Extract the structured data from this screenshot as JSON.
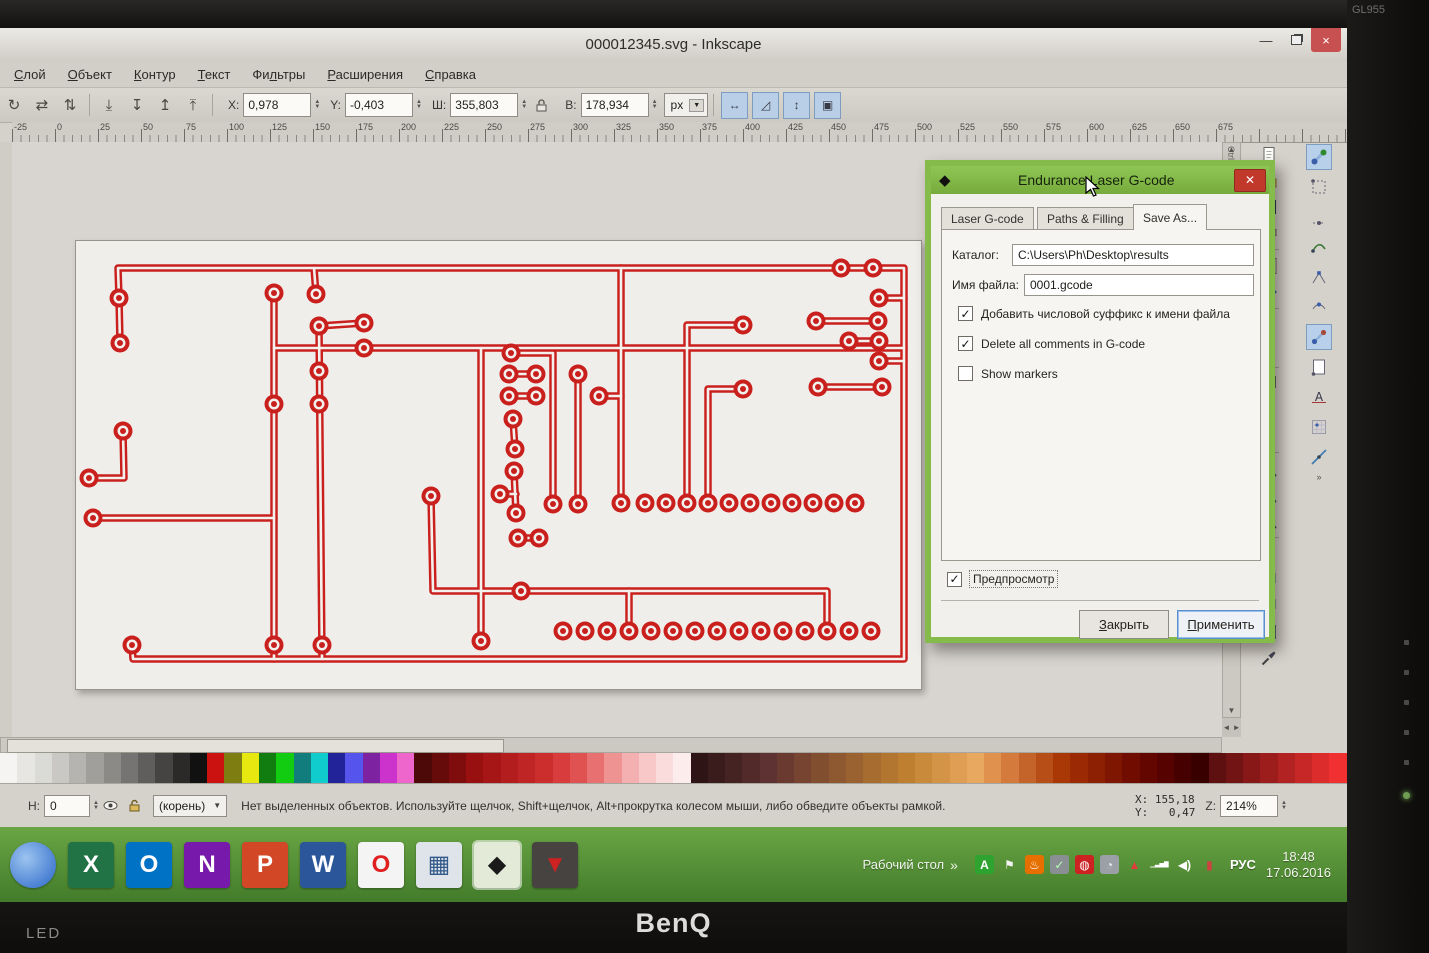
{
  "monitor": {
    "brand": "BenQ",
    "led_label": "LED",
    "model": "GL955",
    "bezel_buttons": [
      "auto-button",
      "menu-button",
      "up-button",
      "down-button",
      "enter-button"
    ]
  },
  "window": {
    "title": "000012345.svg - Inkscape"
  },
  "menu": {
    "items": [
      {
        "label": "Слой",
        "accel": 0
      },
      {
        "label": "Объект",
        "accel": 0
      },
      {
        "label": "Контур",
        "accel": 0
      },
      {
        "label": "Текст",
        "accel": 0
      },
      {
        "label": "Фильтры",
        "accel": 2
      },
      {
        "label": "Расширения",
        "accel": 0
      },
      {
        "label": "Справка",
        "accel": 0
      }
    ]
  },
  "toolbar": {
    "left_icons": [
      {
        "name": "rotate-90-icon",
        "glyph": "↻"
      },
      {
        "name": "flip-horizontal-icon",
        "glyph": "⇄"
      },
      {
        "name": "flip-vertical-icon",
        "glyph": "⇅"
      },
      {
        "name": "lower-to-bottom-icon",
        "glyph": "⤓"
      },
      {
        "name": "lower-icon",
        "glyph": "↧"
      },
      {
        "name": "raise-icon",
        "glyph": "↥"
      },
      {
        "name": "raise-to-top-icon",
        "glyph": "⤒"
      }
    ],
    "fields": [
      {
        "label": "X:",
        "value": "0,978",
        "name": "x-field"
      },
      {
        "label": "Y:",
        "value": "-0,403",
        "name": "y-field"
      },
      {
        "label": "Ш:",
        "value": "355,803",
        "name": "width-field"
      },
      {
        "label": "В:",
        "value": "178,934",
        "name": "height-field"
      }
    ],
    "units": "px",
    "toggle_icons": [
      {
        "name": "scale-stroke-toggle",
        "glyph": "↔"
      },
      {
        "name": "scale-corners-toggle",
        "glyph": "◿"
      },
      {
        "name": "scale-gradients-toggle",
        "glyph": "↕"
      },
      {
        "name": "scale-patterns-toggle",
        "glyph": "▣"
      }
    ]
  },
  "ruler": {
    "start": -25,
    "step": 25,
    "count": 29,
    "px_per_step": 43,
    "offset": 12
  },
  "scrollbars": {
    "ctrl_f_label": "Ctrl+F",
    "up": "▲",
    "down": "▼",
    "left": "◄",
    "right": "►",
    "more": "»"
  },
  "commands_bar": [
    "new-document-icon",
    "open-icon",
    "save-icon",
    "print-icon",
    "sep",
    "import-icon",
    "export-icon",
    "sep",
    "revert-icon",
    "cleanup-icon",
    "sep",
    "duplicate-icon",
    "scissors-icon",
    "clipboard-icon",
    "sep",
    "zoom-selection-icon",
    "zoom-drawing-icon",
    "zoom-page-icon",
    "sep",
    "text-icon",
    "raise-layer-icon",
    "lower-layer-icon",
    "grid-icon",
    "eyedropper-icon"
  ],
  "snap_bar": [
    {
      "name": "snap-master-icon",
      "active": true
    },
    {
      "name": "snap-bbox-icon",
      "active": false
    },
    {
      "name": "snap-bbox-edge-icon",
      "active": false
    },
    {
      "name": "snap-node-path-icon",
      "active": false
    },
    {
      "name": "snap-node-cusp-icon",
      "active": false
    },
    {
      "name": "snap-node-smooth-icon",
      "active": false
    },
    {
      "name": "snap-others-icon",
      "active": true
    },
    {
      "name": "snap-page-icon",
      "active": false
    },
    {
      "name": "snap-text-baseline-icon",
      "active": false
    },
    {
      "name": "snap-grid-icon",
      "active": false
    },
    {
      "name": "snap-guide-icon",
      "active": false
    }
  ],
  "dialog": {
    "title": "Endurance Laser G-code",
    "tabs": [
      "Laser G-code",
      "Paths & Filling",
      "Save As..."
    ],
    "active_tab": "Save As...",
    "fields": {
      "catalog_label": "Каталог:",
      "catalog_value": "C:\\Users\\Ph\\Desktop\\results",
      "filename_label": "Имя файла:",
      "filename_value": "0001.gcode"
    },
    "checkboxes": [
      {
        "label": "Добавить числовой суффикс к имени файла",
        "checked": true
      },
      {
        "label": "Delete all comments in G-code",
        "checked": true
      },
      {
        "label": "Show markers",
        "checked": false
      }
    ],
    "preview_checkbox": {
      "label": "Предпросмотр",
      "checked": true
    },
    "buttons": [
      {
        "label": "Закрыть",
        "accel": 0,
        "name": "dialog-close-button"
      },
      {
        "label": "Применить",
        "accel": 0,
        "name": "dialog-apply-button"
      }
    ]
  },
  "statusbar": {
    "opacity_label": "Н:",
    "opacity_value": "0",
    "layer_name": "(корень)",
    "message": "Нет выделенных объектов. Используйте щелчок, Shift+щелчок, Alt+прокрутка колесом мыши, либо обведите объекты рамкой.",
    "x_label": "X:",
    "x_value": "155,18",
    "y_label": "Y:",
    "y_value": "0,47",
    "z_label": "Z:",
    "zoom_value": "214%"
  },
  "taskbar": {
    "desktop_label": "Рабочий стол",
    "chevron": "»",
    "lang_indicator": "РУС",
    "time": "18:48",
    "date": "17.06.2016",
    "apps": [
      {
        "name": "blue-orb-app",
        "glyph": "",
        "bg": "radial-gradient(circle at 35% 35%, #9cc4f0, #2a66c8)",
        "fg": "#ffffff",
        "round": true,
        "active": false
      },
      {
        "name": "excel",
        "glyph": "X",
        "bg": "#217346",
        "fg": "#ffffff",
        "active": false
      },
      {
        "name": "outlook",
        "glyph": "O",
        "bg": "#0072c6",
        "fg": "#ffffff",
        "active": false
      },
      {
        "name": "onenote",
        "glyph": "N",
        "bg": "#7719aa",
        "fg": "#ffffff",
        "active": false
      },
      {
        "name": "powerpoint",
        "glyph": "P",
        "bg": "#d24726",
        "fg": "#ffffff",
        "active": false
      },
      {
        "name": "word",
        "glyph": "W",
        "bg": "#2b579a",
        "fg": "#ffffff",
        "active": false
      },
      {
        "name": "opera",
        "glyph": "O",
        "bg": "#f4f4f4",
        "fg": "#e02020",
        "active": false
      },
      {
        "name": "calculator",
        "glyph": "▦",
        "bg": "#dfe4ea",
        "fg": "#335a8a",
        "active": false
      },
      {
        "name": "inkscape",
        "glyph": "◆",
        "bg": "#e4ead8",
        "fg": "#1a1a1a",
        "active": true
      },
      {
        "name": "laser-app",
        "glyph": "▼",
        "bg": "#474340",
        "fg": "#cc2222",
        "active": false
      }
    ],
    "tray": [
      {
        "name": "punto-switcher-icon",
        "glyph": "A",
        "bg": "#2fa32f",
        "fg": "#ffffff"
      },
      {
        "name": "action-center-flag-icon",
        "glyph": "⚑",
        "bg": "transparent",
        "fg": "#f2f2f2"
      },
      {
        "name": "java-icon",
        "glyph": "♨",
        "bg": "#e76f00",
        "fg": "#ffffff"
      },
      {
        "name": "usb-eject-icon",
        "glyph": "✓",
        "bg": "#8a8f94",
        "fg": "#b8ffb8"
      },
      {
        "name": "antivirus-icon",
        "glyph": "◍",
        "bg": "#cc2222",
        "fg": "#ffffff"
      },
      {
        "name": "cloud-icon",
        "glyph": "◔",
        "bg": "#9aa0a6",
        "fg": "#f0f0f0"
      },
      {
        "name": "warning-icon",
        "glyph": "▲",
        "bg": "transparent",
        "fg": "#e03a3a"
      },
      {
        "name": "network-signal-icon",
        "glyph": "▁▃▅▇",
        "bg": "transparent",
        "fg": "#ffffff"
      },
      {
        "name": "volume-icon",
        "glyph": "◀)",
        "bg": "transparent",
        "fg": "#ffffff"
      },
      {
        "name": "battery-icon",
        "glyph": "▮",
        "bg": "transparent",
        "fg": "#d04040"
      }
    ]
  },
  "palette": {
    "colors": [
      "#f5f4f2",
      "#e8e6e3",
      "#dadad7",
      "#c9c8c5",
      "#b5b4b1",
      "#a09f9c",
      "#8b8a87",
      "#757472",
      "#5f5e5c",
      "#454443",
      "#2b2a29",
      "#111111",
      "#cc1111",
      "#7d7d11",
      "#e8e811",
      "#117d11",
      "#11cc11",
      "#117d7d",
      "#11cccc",
      "#222299",
      "#5555ee",
      "#7d22a0",
      "#cc33cc",
      "#ee66cc",
      "#4d0808",
      "#660a0a",
      "#800d0d",
      "#991010",
      "#a61616",
      "#b31d1d",
      "#bf2525",
      "#cc2e2e",
      "#d83c3c",
      "#e05252",
      "#e87070",
      "#ef9292",
      "#f4b0b0",
      "#f8c8c8",
      "#fbdcdc",
      "#fdecec",
      "#2e1414",
      "#3a1c1c",
      "#462323",
      "#522a2a",
      "#5e3232",
      "#6a3a30",
      "#764430",
      "#824e30",
      "#8e5830",
      "#9a6230",
      "#a66c30",
      "#b27630",
      "#be8030",
      "#c98a3c",
      "#d49448",
      "#df9e54",
      "#e9a860",
      "#e1914e",
      "#d37a3c",
      "#c5642a",
      "#b74e18",
      "#a93806",
      "#9b2a04",
      "#8d2002",
      "#7f1601",
      "#710c00",
      "#630600",
      "#550200",
      "#470000",
      "#390000",
      "#5e1010",
      "#731414",
      "#881818",
      "#9d1d1d",
      "#b22222",
      "#c72727",
      "#dc2c2c",
      "#f13131"
    ]
  },
  "canvas": {
    "pcb": {
      "trace_color": "#c9201e",
      "hollow_color": "#f3f1ed",
      "traces": [
        [
          [
            56,
            404
          ],
          [
            57,
            418
          ],
          [
            828,
            418
          ],
          [
            828,
            27
          ],
          [
            42,
            27
          ],
          [
            43,
            57
          ],
          [
            44,
            102
          ]
        ],
        [
          [
            198,
            52
          ],
          [
            198,
            418
          ]
        ],
        [
          [
            238,
            27
          ],
          [
            240,
            53
          ]
        ],
        [
          [
            243,
            85
          ],
          [
            246,
            418
          ]
        ],
        [
          [
            243,
            85
          ],
          [
            288,
            82
          ]
        ],
        [
          [
            198,
            107
          ],
          [
            828,
            107
          ]
        ],
        [
          [
            17,
            277
          ],
          [
            198,
            277
          ]
        ],
        [
          [
            13,
            237
          ],
          [
            48,
            237
          ],
          [
            47,
            190
          ]
        ],
        [
          [
            355,
            255
          ],
          [
            357,
            350
          ],
          [
            751,
            350
          ],
          [
            751,
            390
          ]
        ],
        [
          [
            553,
            350
          ],
          [
            553,
            390
          ]
        ],
        [
          [
            405,
            107
          ],
          [
            405,
            400
          ]
        ],
        [
          [
            435,
            112
          ],
          [
            477,
            112
          ],
          [
            477,
            263
          ]
        ],
        [
          [
            502,
            133
          ],
          [
            502,
            263
          ]
        ],
        [
          [
            433,
            133
          ],
          [
            460,
            133
          ]
        ],
        [
          [
            433,
            155
          ],
          [
            460,
            155
          ]
        ],
        [
          [
            437,
            178
          ],
          [
            439,
            208
          ]
        ],
        [
          [
            438,
            230
          ],
          [
            440,
            272
          ]
        ],
        [
          [
            424,
            253
          ],
          [
            440,
            253
          ]
        ],
        [
          [
            442,
            297
          ],
          [
            463,
            297
          ]
        ],
        [
          [
            545,
            27
          ],
          [
            545,
            262
          ]
        ],
        [
          [
            523,
            155
          ],
          [
            545,
            155
          ]
        ],
        [
          [
            667,
            84
          ],
          [
            611,
            84
          ],
          [
            611,
            262
          ]
        ],
        [
          [
            667,
            148
          ],
          [
            632,
            148
          ],
          [
            632,
            262
          ]
        ],
        [
          [
            803,
            57
          ],
          [
            828,
            57
          ]
        ],
        [
          [
            740,
            80
          ],
          [
            802,
            80
          ]
        ],
        [
          [
            773,
            100
          ],
          [
            803,
            100
          ]
        ],
        [
          [
            803,
            120
          ],
          [
            828,
            120
          ]
        ],
        [
          [
            742,
            146
          ],
          [
            806,
            146
          ]
        ]
      ],
      "pads": [
        [
          43,
          57
        ],
        [
          44,
          102
        ],
        [
          56,
          404
        ],
        [
          198,
          52
        ],
        [
          198,
          163
        ],
        [
          198,
          404
        ],
        [
          240,
          53
        ],
        [
          243,
          85
        ],
        [
          288,
          82
        ],
        [
          288,
          107
        ],
        [
          243,
          130
        ],
        [
          243,
          163
        ],
        [
          246,
          404
        ],
        [
          17,
          277
        ],
        [
          13,
          237
        ],
        [
          47,
          190
        ],
        [
          355,
          255
        ],
        [
          445,
          350
        ],
        [
          405,
          400
        ],
        [
          435,
          112
        ],
        [
          477,
          263
        ],
        [
          502,
          133
        ],
        [
          502,
          263
        ],
        [
          433,
          133
        ],
        [
          460,
          133
        ],
        [
          433,
          155
        ],
        [
          460,
          155
        ],
        [
          437,
          178
        ],
        [
          439,
          208
        ],
        [
          438,
          230
        ],
        [
          424,
          253
        ],
        [
          440,
          272
        ],
        [
          442,
          297
        ],
        [
          463,
          297
        ],
        [
          523,
          155
        ],
        [
          667,
          84
        ],
        [
          667,
          148
        ],
        [
          765,
          27
        ],
        [
          797,
          27
        ],
        [
          803,
          57
        ],
        [
          740,
          80
        ],
        [
          802,
          80
        ],
        [
          773,
          100
        ],
        [
          803,
          100
        ],
        [
          803,
          120
        ],
        [
          742,
          146
        ],
        [
          806,
          146
        ]
      ],
      "pad_rows": [
        {
          "y": 262,
          "xs": [
            545,
            569,
            590,
            611,
            632,
            653,
            674,
            695,
            716,
            737,
            758,
            779
          ]
        },
        {
          "y": 390,
          "xs": [
            487,
            509,
            531,
            553,
            575,
            597,
            619,
            641,
            663,
            685,
            707,
            729,
            751,
            773,
            795
          ]
        }
      ]
    }
  }
}
